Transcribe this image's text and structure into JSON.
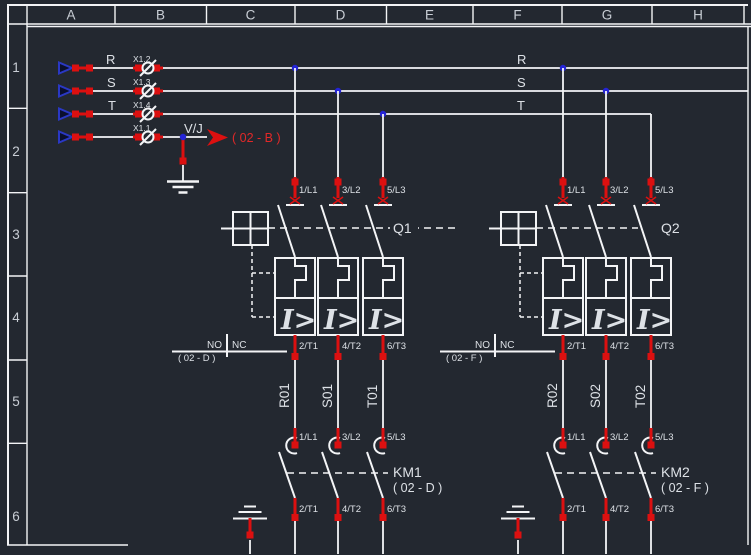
{
  "palette": {
    "background": "#232830",
    "line_white": "#f3f4f6",
    "wire_red": "#dc1010",
    "junction_blue": "#2424d6",
    "text_red": "#e22828"
  },
  "frame": {
    "columns": [
      "A",
      "B",
      "C",
      "D",
      "E",
      "F",
      "G",
      "H"
    ],
    "rows": [
      "1",
      "2",
      "3",
      "4",
      "5",
      "6"
    ]
  },
  "power_in": {
    "phase_labels": [
      "R",
      "S",
      "T"
    ],
    "neutral_label": "V/J",
    "terminal_labels": [
      "X1.2",
      "X1.3",
      "X1.4",
      "X1.1"
    ],
    "phase_labels_right": [
      "R",
      "S",
      "T"
    ],
    "crossref": "( 02 - B )"
  },
  "branches": [
    {
      "breaker": {
        "tag": "Q1",
        "trip": "I>",
        "top_terminals": [
          "1/L1",
          "3/L2",
          "5/L3"
        ],
        "bottom_terminals": [
          "2/T1",
          "4/T2",
          "6/T3"
        ],
        "aux": {
          "no": "NO",
          "nc": "NC",
          "ref": "( 02 - D )"
        }
      },
      "wire_numbers": [
        "R01",
        "S01",
        "T01"
      ],
      "contactor": {
        "tag": "KM1",
        "ref": "( 02 - D )",
        "top_terminals": [
          "1/L1",
          "3/L2",
          "5/L3"
        ],
        "bottom_terminals": [
          "2/T1",
          "4/T2",
          "6/T3"
        ]
      }
    },
    {
      "breaker": {
        "tag": "Q2",
        "trip": "I>",
        "top_terminals": [
          "1/L1",
          "3/L2",
          "5/L3"
        ],
        "bottom_terminals": [
          "2/T1",
          "4/T2",
          "6/T3"
        ],
        "aux": {
          "no": "NO",
          "nc": "NC",
          "ref": "( 02 - F )"
        }
      },
      "wire_numbers": [
        "R02",
        "S02",
        "T02"
      ],
      "contactor": {
        "tag": "KM2",
        "ref": "( 02 - F )",
        "top_terminals": [
          "1/L1",
          "3/L2",
          "5/L3"
        ],
        "bottom_terminals": [
          "2/T1",
          "4/T2",
          "6/T3"
        ]
      }
    }
  ]
}
